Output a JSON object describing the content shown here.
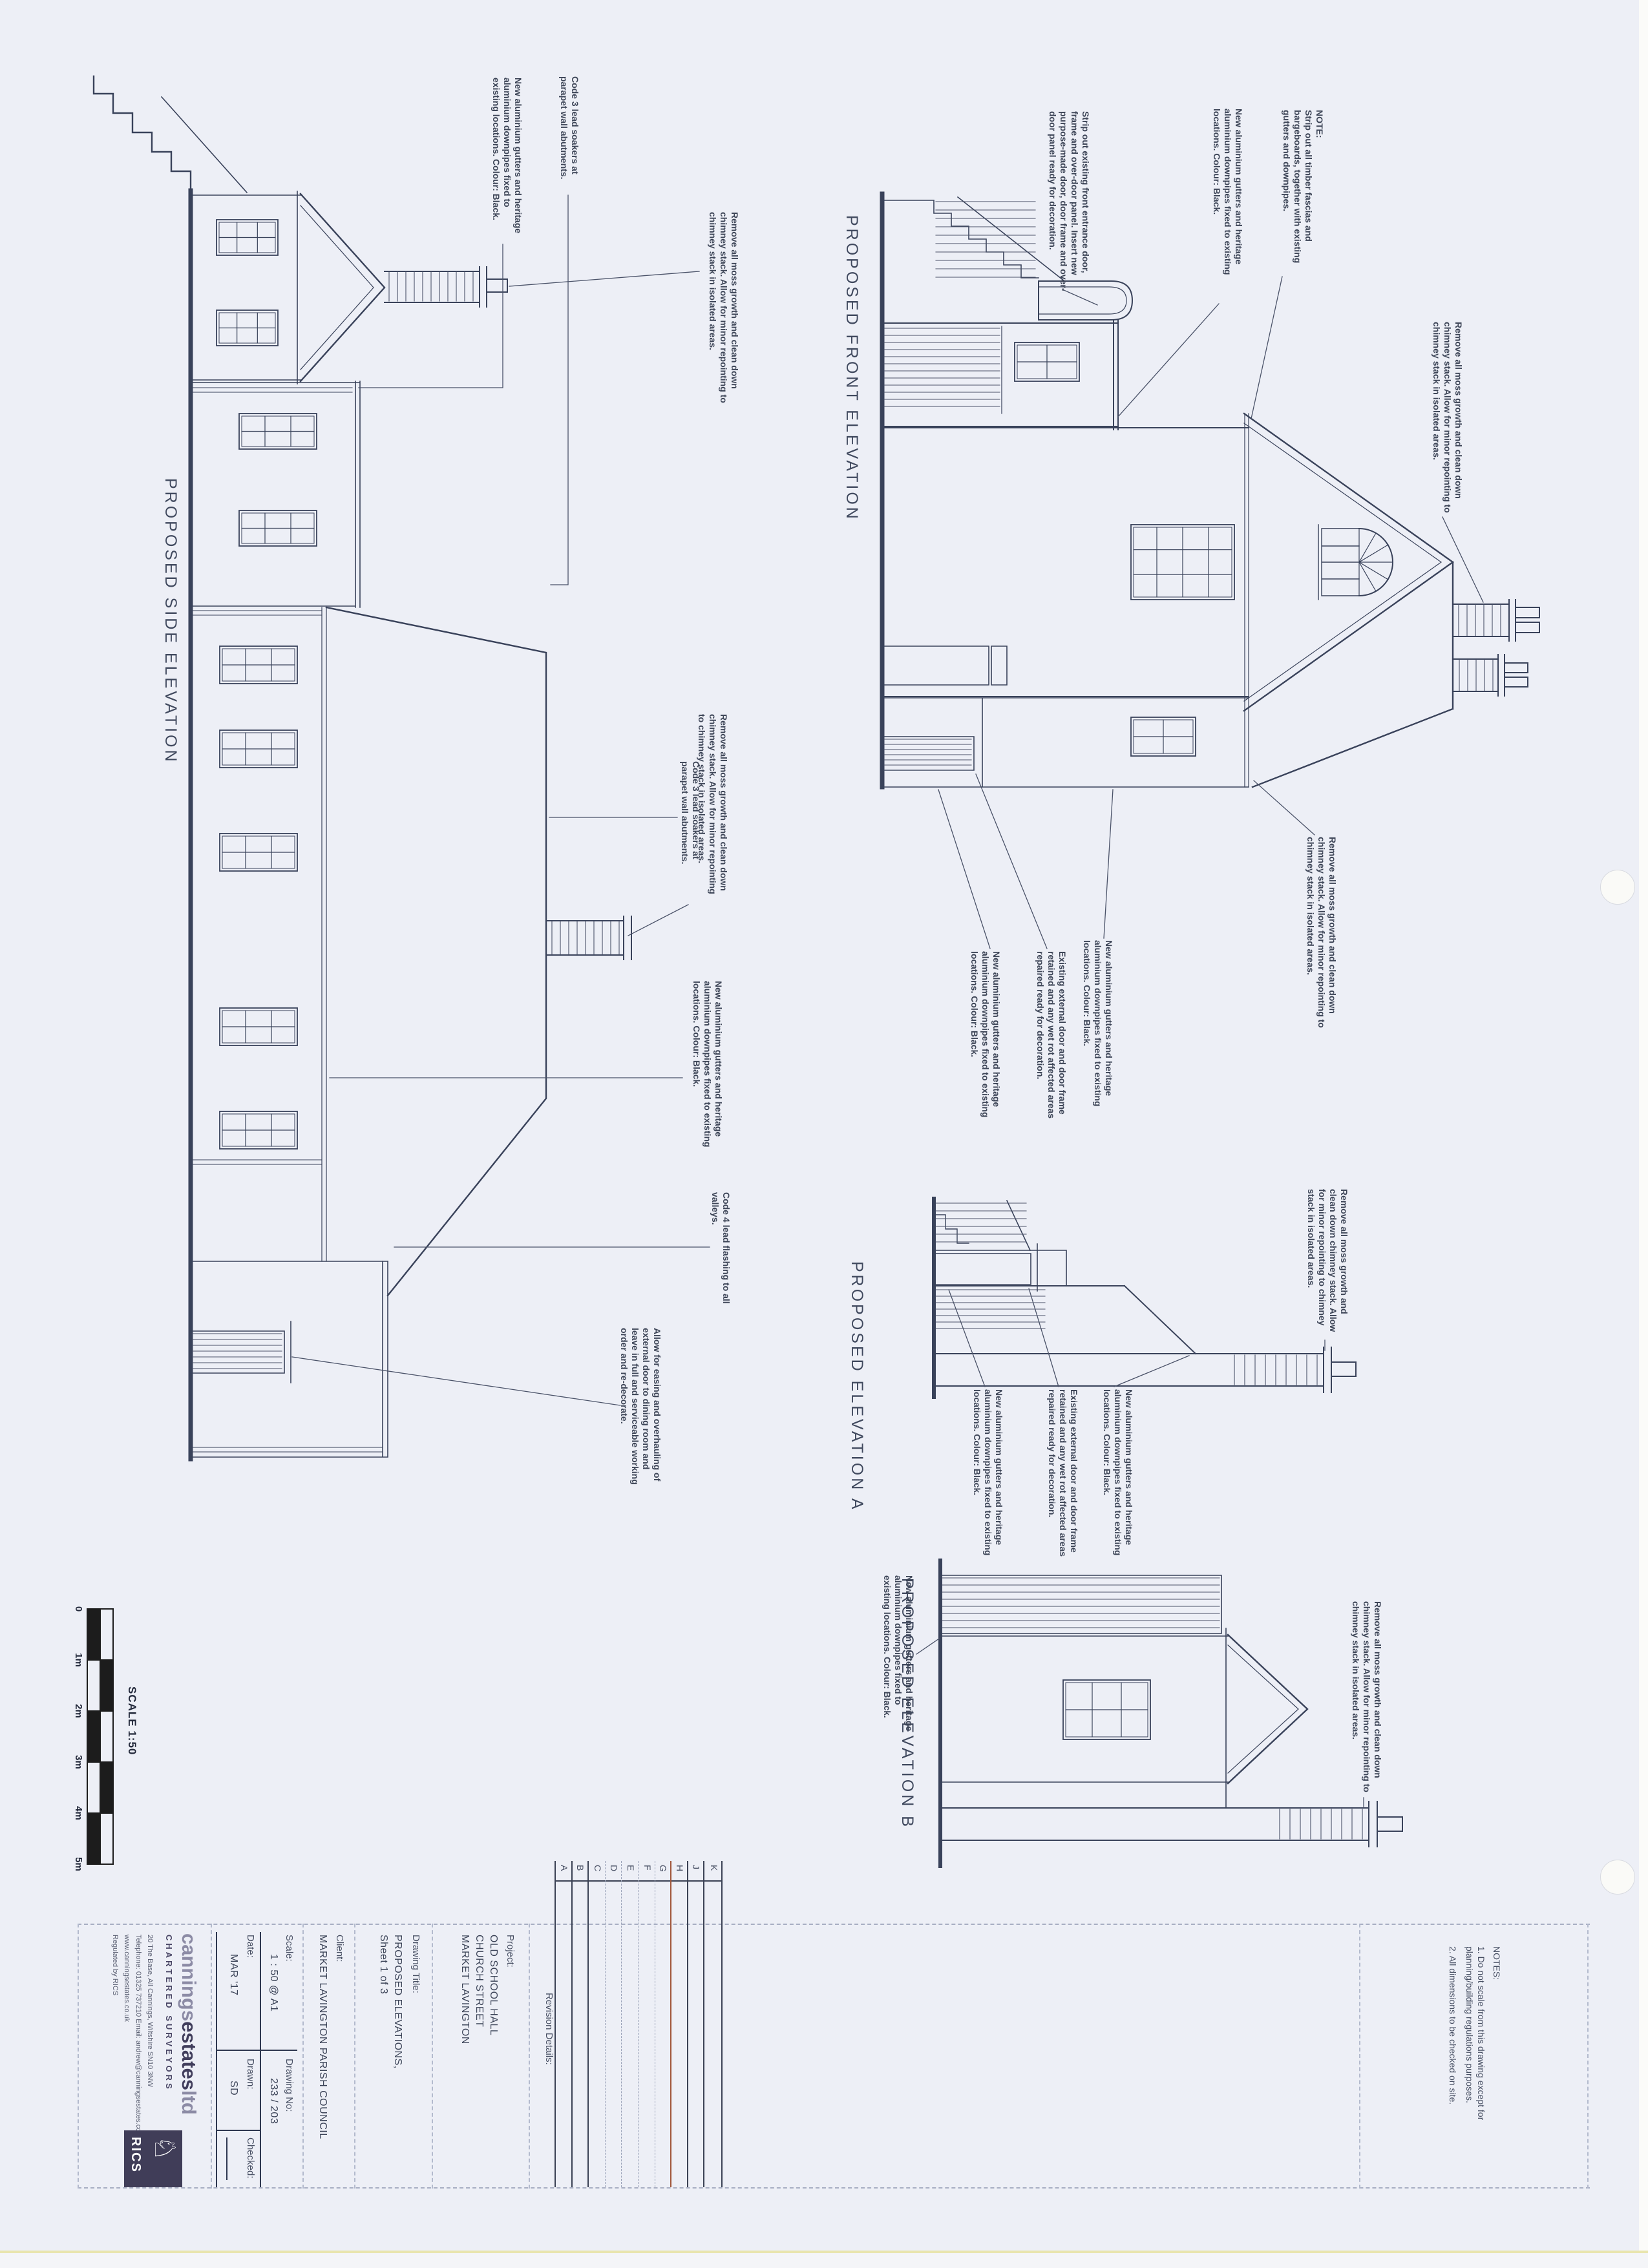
{
  "views": {
    "front": "PROPOSED FRONT ELEVATION",
    "side": "PROPOSED SIDE ELEVATION",
    "a": "PROPOSED ELEVATION A",
    "b": "PROPOSED ELEVATION B"
  },
  "scale_bar": {
    "title": "SCALE 1:50",
    "ticks": [
      "0",
      "1m",
      "2m",
      "3m",
      "4m",
      "5m"
    ]
  },
  "annotations": [
    {
      "text": "NOTE:\nStrip out all timber fascias and bargeboards, together with existing gutters and downpipes."
    },
    {
      "text": "New aluminium gutters and heritage aluminium downpipes fixed to existing locations.  Colour: Black."
    },
    {
      "text": "Strip out existing front entrance door, frame and over-door panel. Insert new purpose-made door, door frame and over-door panel ready for decoration."
    },
    {
      "text": "Remove all moss growth and clean down chimney stack. Allow for minor repointing to chimney stack in isolated areas."
    },
    {
      "text": "Remove all moss growth and clean down chimney stack. Allow for minor repointing to chimney stack in isolated areas."
    },
    {
      "text": "New aluminium gutters and heritage aluminium downpipes fixed to existing locations.  Colour: Black."
    },
    {
      "text": "Existing external door and door frame retained and any wet rot affected areas repaired ready for decoration."
    },
    {
      "text": "New aluminium gutters and heritage aluminium downpipes fixed to existing locations.  Colour: Black."
    },
    {
      "text": "Code 3 lead soakers at parapet wall abutments."
    },
    {
      "text": "New aluminium gutters and heritage aluminium downpipes fixed to existing locations.  Colour: Black."
    },
    {
      "text": "Remove all moss growth and clean down chimney stack. Allow for minor repointing to chimney stack in isolated areas."
    },
    {
      "text": "Remove all moss growth and clean down chimney stack. Allow for minor repointing to chimney stack in isolated areas."
    },
    {
      "text": "Code 3 lead soakers at parapet wall abutments."
    },
    {
      "text": "New aluminium gutters and heritage aluminium downpipes fixed to existing locations.  Colour: Black."
    },
    {
      "text": "Code 4 lead flashing to all valleys."
    },
    {
      "text": "Allow for easing and overhauling of external door to dining room and leave in full and serviceable working order and re-decorate."
    },
    {
      "text": "New aluminium gutters and heritage aluminium downpipes fixed to existing locations.  Colour: Black."
    },
    {
      "text": "Existing external door and door frame retained and any wet rot affected areas repaired ready for decoration."
    },
    {
      "text": "New aluminium gutters and heritage aluminium downpipes fixed to existing locations.  Colour: Black."
    },
    {
      "text": "Remove all moss growth and clean down chimney stack. Allow for minor repointing to chimney stack in isolated areas."
    },
    {
      "text": "Remove all moss growth and clean down chimney stack. Allow for minor repointing to chimney stack in isolated areas."
    },
    {
      "text": "New aluminium gutters and heritage aluminium downpipes fixed to existing locations.  Colour: Black."
    }
  ],
  "title_block": {
    "notes": {
      "heading": "NOTES:",
      "items": [
        "1. Do not scale from this drawing except for planning/building regulations purposes.",
        "2. All dimensions to be checked on site."
      ]
    },
    "revision": {
      "label": "Revision Details:",
      "rows": [
        "K",
        "J",
        "H",
        "G",
        "F",
        "E",
        "D",
        "C",
        "B",
        "A"
      ]
    },
    "project": {
      "label": "Project:",
      "lines": "OLD SCHOOL HALL\nCHURCH STREET\nMARKET LAVINGTON"
    },
    "drawing_title": {
      "label": "Drawing Title:",
      "lines": "PROPOSED ELEVATIONS,\nSheet 1 of 3"
    },
    "client": {
      "label": "Client:",
      "value": "MARKET LAVINGTON PARISH COUNCIL"
    },
    "fields": {
      "scale_label": "Scale:",
      "scale": "1 : 50 @ A1",
      "date_label": "Date:",
      "date": "MAR '17",
      "drawing_no_label": "Drawing No:",
      "drawing_no": "233 / 203",
      "drawn_label": "Drawn:",
      "drawn": "SD",
      "checked_label": "Checked:"
    },
    "firm": {
      "name_1": "cannings",
      "name_2": "estates",
      "name_3": "ltd",
      "tagline": "CHARTERED SURVEYORS",
      "address": "20 The Base, All Cannings, Wiltshire SN10 3NW",
      "contact": "Telephone: 01325 737210   Email: andrew@canningsestates.co.uk",
      "web": "www.canningsestates.co.uk",
      "regulated": "Regulated by RICS",
      "rics": "RICS"
    }
  },
  "colors": {
    "paper": "#edeff6",
    "ink": "#39425a",
    "logo_navy": "#403d58",
    "revision_red": "#a0563a",
    "scale_black": "#1c1c1c"
  }
}
